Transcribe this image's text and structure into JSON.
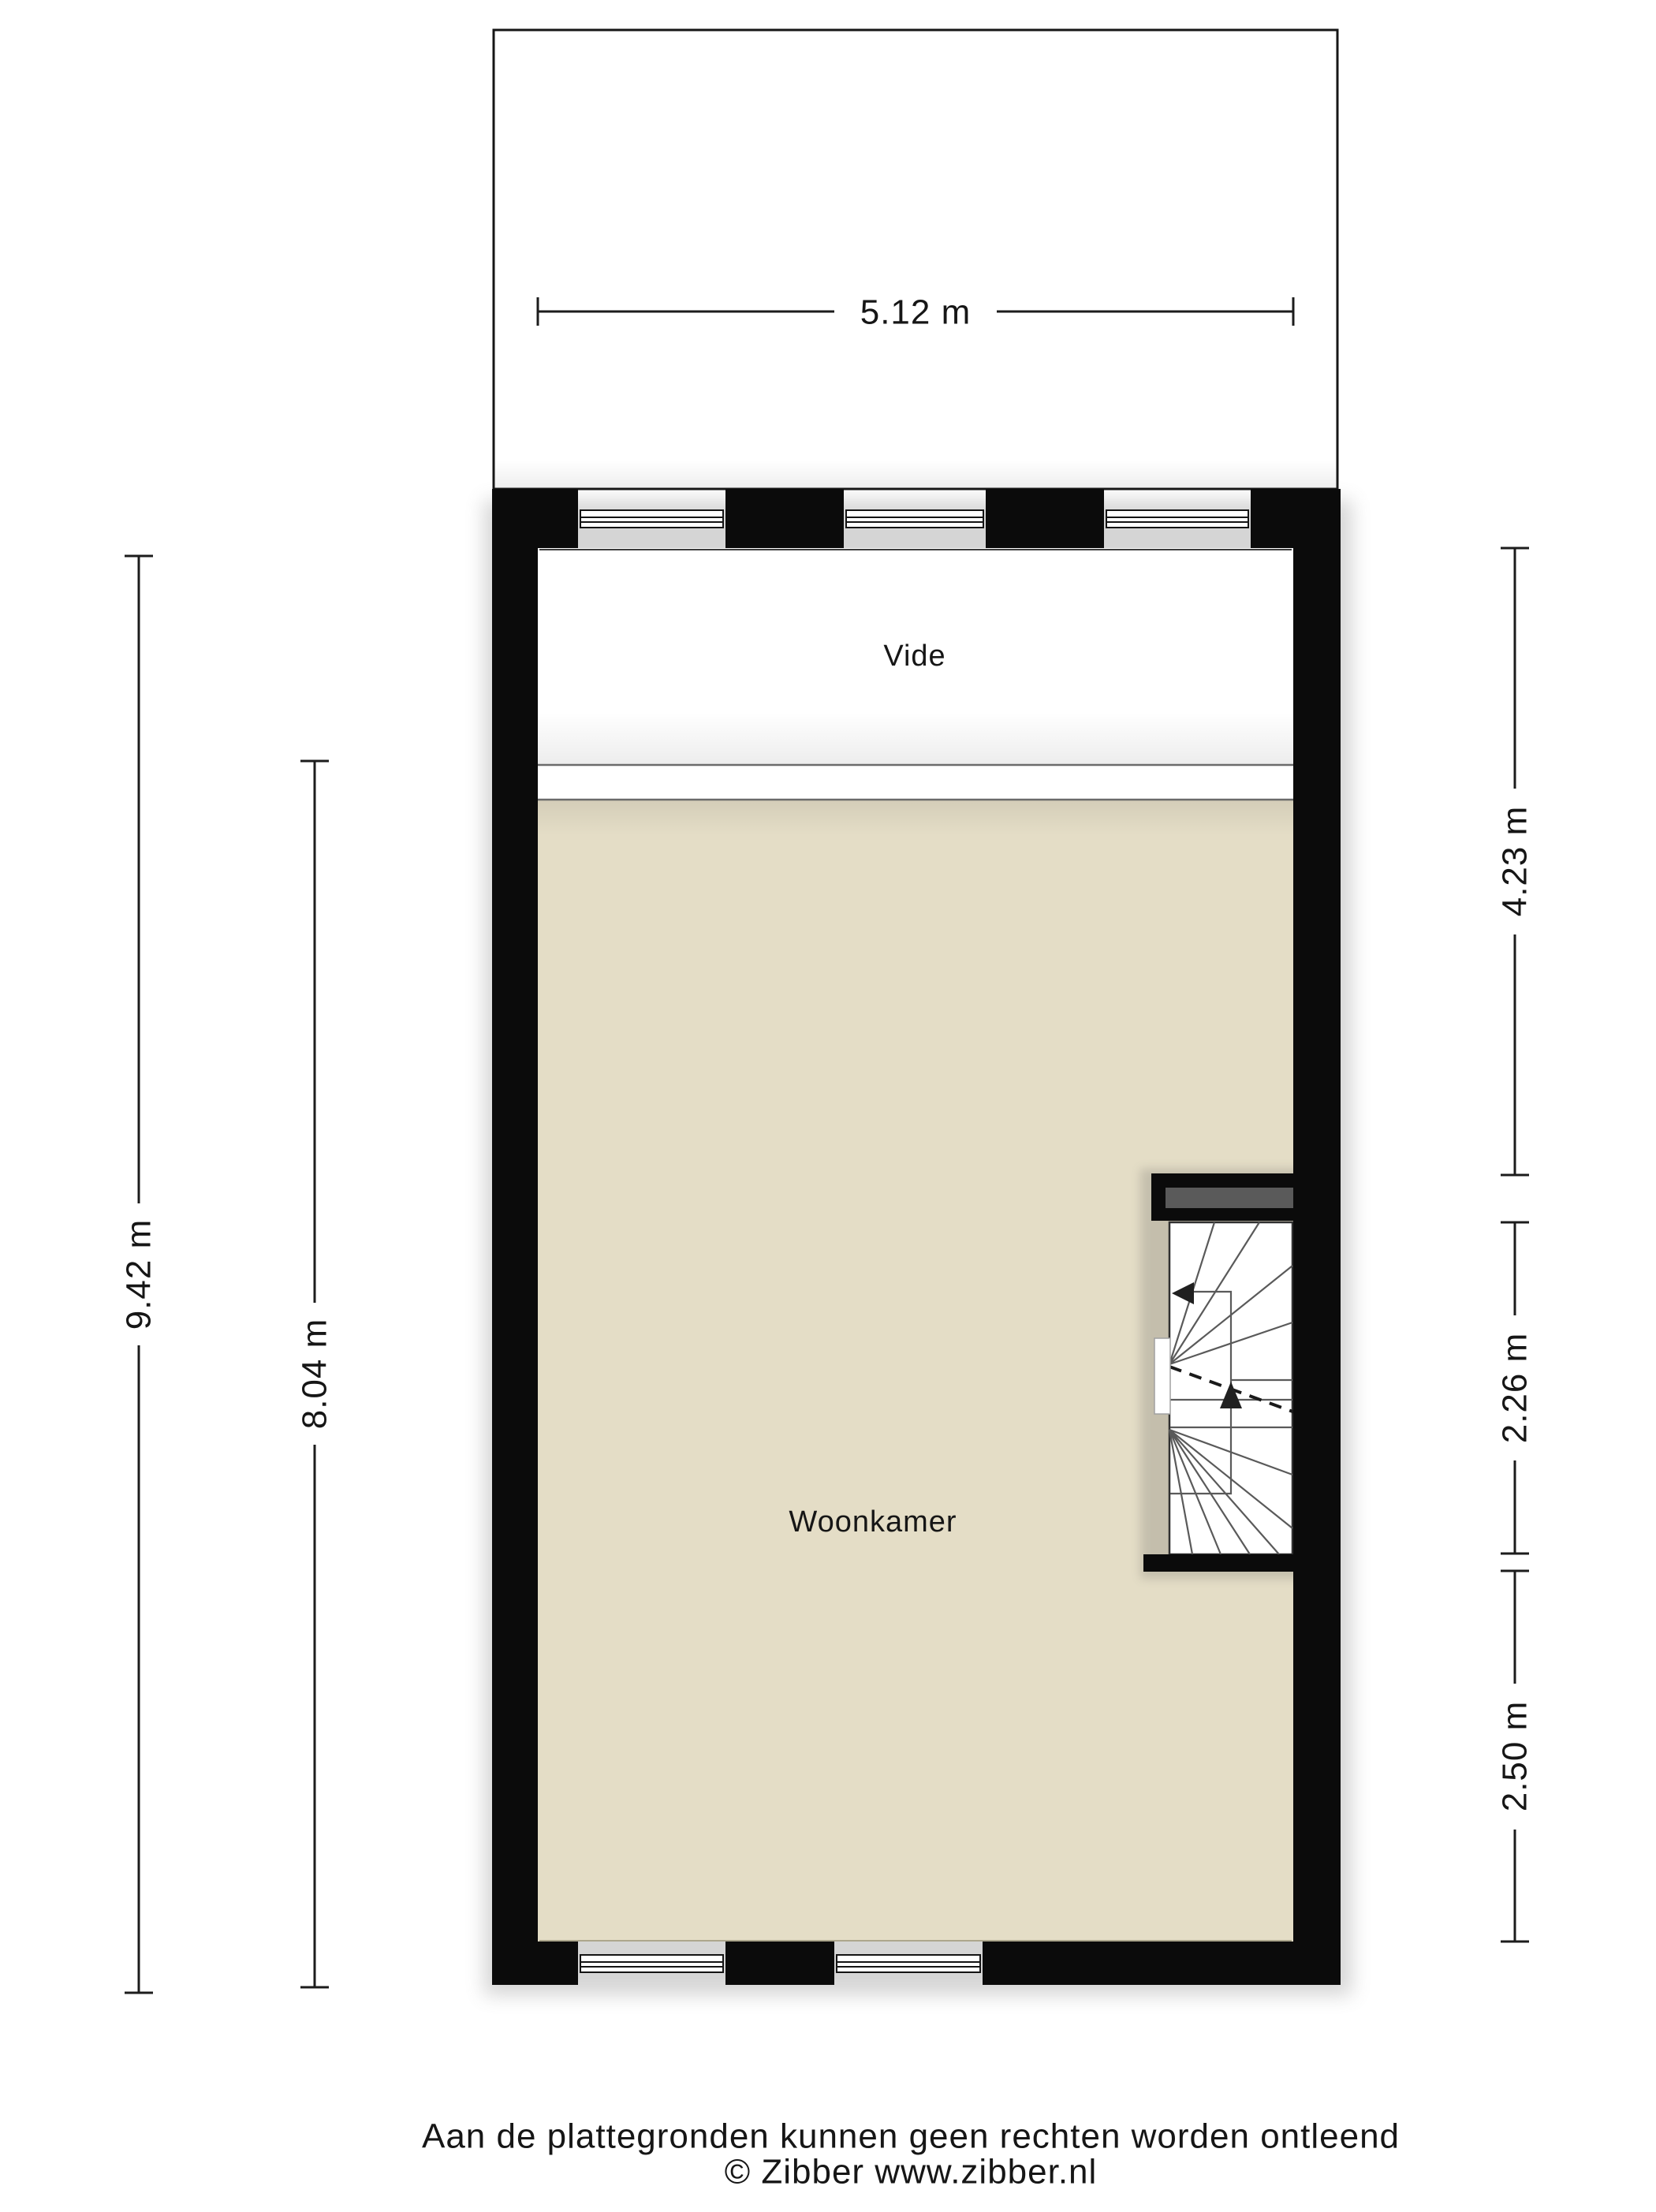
{
  "rooms": {
    "vide": "Vide",
    "woonkamer": "Woonkamer"
  },
  "dimensions": {
    "width_top": "5.12 m",
    "height_outer_left": "9.42 m",
    "height_inner_left": "8.04 m",
    "right_upper": "4.23 m",
    "right_middle": "2.26 m",
    "right_lower": "2.50 m"
  },
  "footer": {
    "disclaimer": "Aan de plattegronden kunnen geen rechten worden ontleend",
    "copyright": "© Zibber www.zibber.nl"
  },
  "colors": {
    "wall": "#0b0b0b",
    "woonkamer_floor": "#e4ddc6",
    "vide_floor": "#ffffff",
    "beam": "#5a5a5a",
    "stair_line": "#5a5a5a",
    "dimension": "#1c1c1c"
  }
}
